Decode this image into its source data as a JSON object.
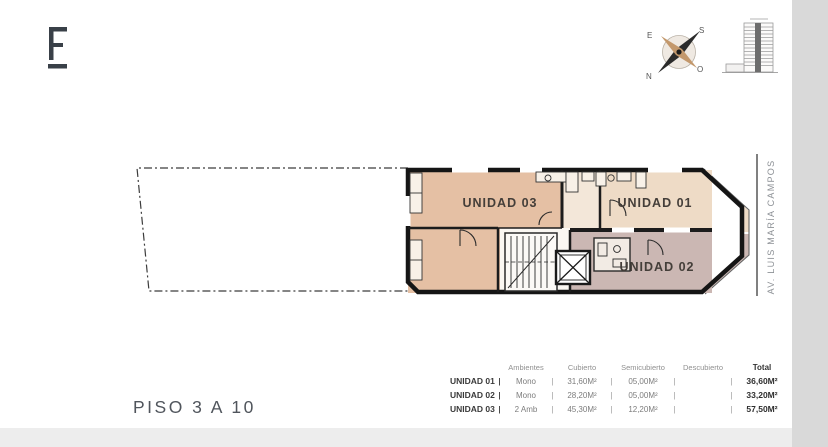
{
  "compass": {
    "top_left": "E",
    "top_right": "S",
    "bottom_left": "N",
    "bottom_right": "O"
  },
  "street": {
    "name": "AV. LUIS MARÍA CAMPOS"
  },
  "plan": {
    "floor_label": "PISO 3 A 10",
    "units": [
      {
        "id": "unidad-01",
        "label": "UNIDAD 01",
        "color": "#eedbc6"
      },
      {
        "id": "unidad-02",
        "label": "UNIDAD 02",
        "color": "#cbb7b3"
      },
      {
        "id": "unidad-03",
        "label": "UNIDAD 03",
        "color": "#e5c0a4"
      }
    ]
  },
  "icons": {
    "logo": "brand-logo-mark",
    "compass": "compass-rose",
    "tower": "building-elevation"
  },
  "table": {
    "separator": "|",
    "headers": [
      "Ambientes",
      "Cubierto",
      "Semicubierto",
      "Descubierto",
      "Total"
    ],
    "rows": [
      {
        "label": "UNIDAD 01",
        "ambientes": "Mono",
        "cubierto": "31,60M²",
        "semicubierto": "05,00M²",
        "descubierto": "",
        "total": "36,60M²"
      },
      {
        "label": "UNIDAD 02",
        "ambientes": "Mono",
        "cubierto": "28,20M²",
        "semicubierto": "05,00M²",
        "descubierto": "",
        "total": "33,20M²"
      },
      {
        "label": "UNIDAD 03",
        "ambientes": "2 Amb",
        "cubierto": "45,30M²",
        "semicubierto": "12,20M²",
        "descubierto": "",
        "total": "57,50M²"
      }
    ]
  }
}
